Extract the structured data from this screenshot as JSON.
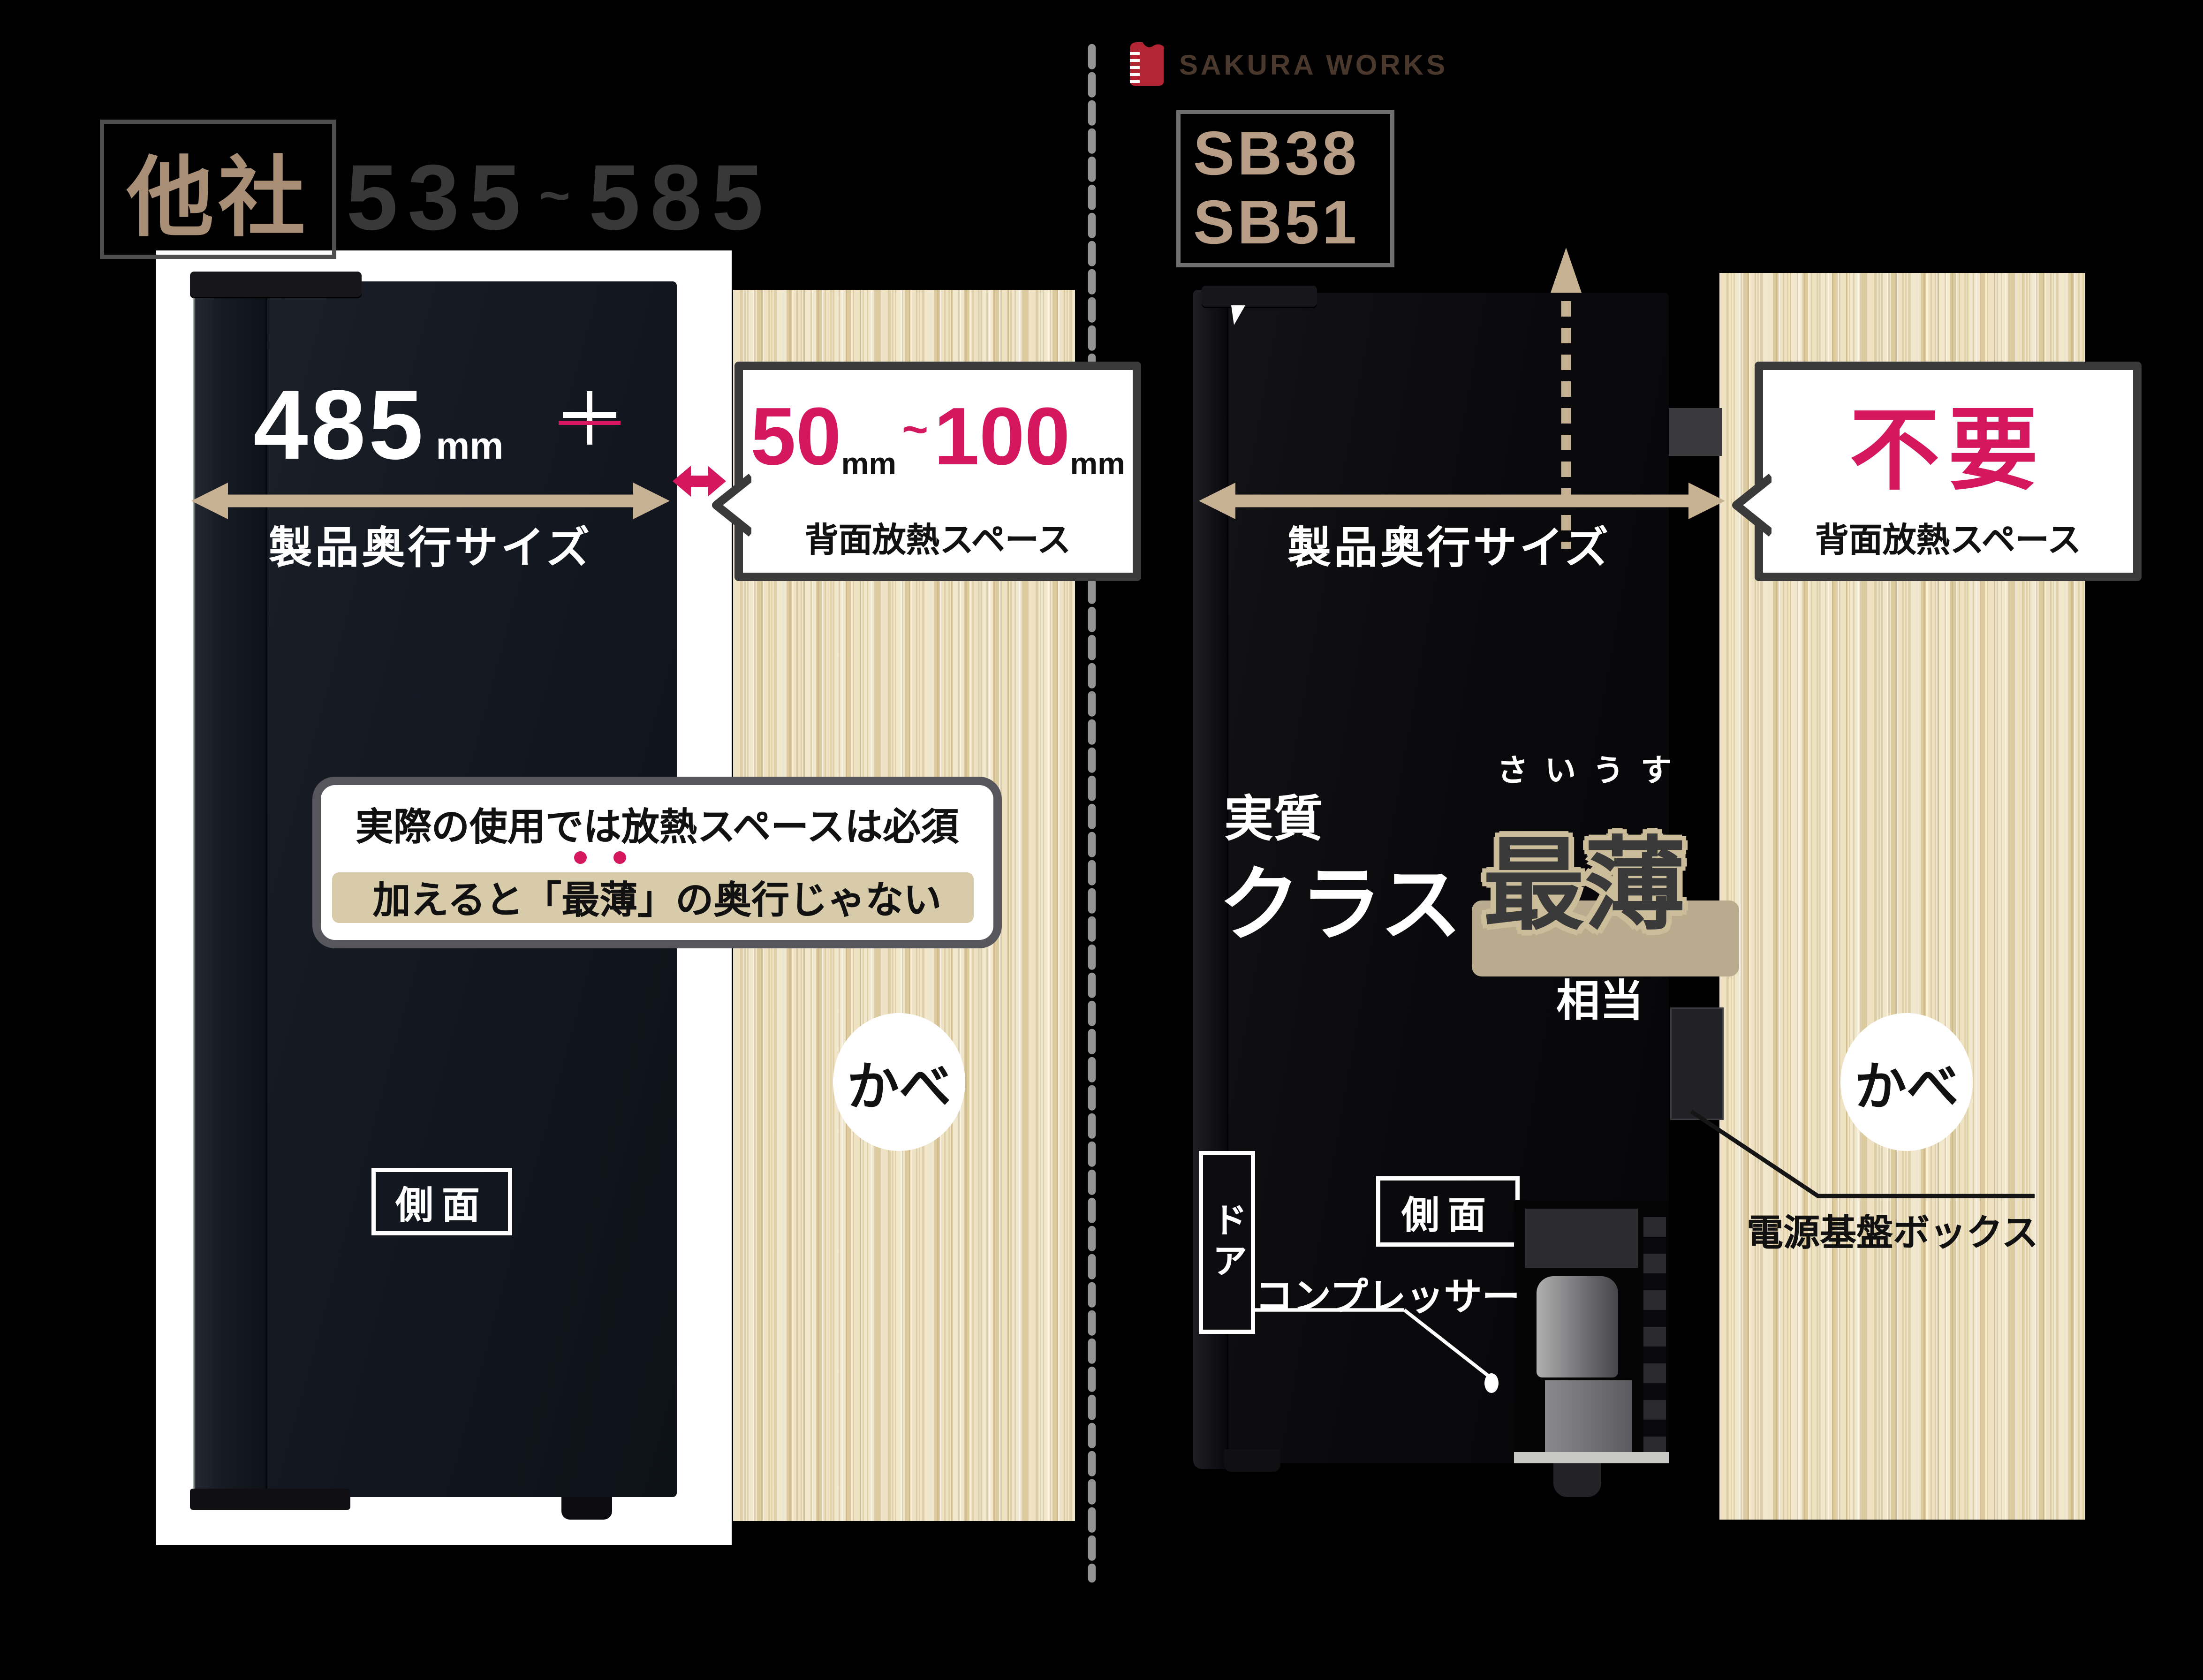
{
  "brand": {
    "logo_text": "SAKURA WORKS"
  },
  "left_panel": {
    "maker_label": "他社",
    "depth_range": {
      "min": "535",
      "tilde": "~",
      "max": "585"
    },
    "depth": {
      "value": "485",
      "unit": "mm",
      "caption": "製品奥行サイズ"
    },
    "gap_callout": {
      "min": "50",
      "tilde": "~",
      "max": "100",
      "unit": "mm",
      "caption": "背面放熱スペース"
    },
    "note": {
      "line1": "実際の使用では放熱スペースは必須",
      "line2": "加えると「最薄」の奥行じゃない"
    },
    "wall_label": "かべ",
    "side_label": "側面"
  },
  "right_panel": {
    "models": [
      "SB38",
      "SB51"
    ],
    "depth_caption": "製品奥行サイズ",
    "gap_callout": {
      "headline": "不要",
      "caption": "背面放熱スペース"
    },
    "claim": {
      "prefix": "実質",
      "class_word": "クラス",
      "furigana": "さいうす",
      "highlight": "最薄",
      "suffix": "相当"
    },
    "door_label": "ドア",
    "side_label": "側面",
    "compressor_label": "コンプレッサー",
    "power_board_label": "電源基盤ボックス",
    "wall_label": "かべ"
  },
  "icons": {
    "plus_icon": "+",
    "gap_arrow_icon": "double-horizontal-arrow",
    "depth_arrow_icon": "double-horizontal-arrow",
    "heat_flow_icon": "dashed-up-arrow",
    "logo_mark": "red-ruler-book-mark",
    "emphasis_dots": "••"
  },
  "colors": {
    "background": "#000000",
    "accent_pink": "#d4175f",
    "measure_tan": "#c6b292",
    "maker_tan": "#a98e76",
    "model_tan": "#b79d85",
    "range_gray": "#383838",
    "wood": "#e8dbb6",
    "logo_red": "#b32532",
    "divider_gray": "#939393",
    "highlight_strip": "#d8cbaa"
  }
}
